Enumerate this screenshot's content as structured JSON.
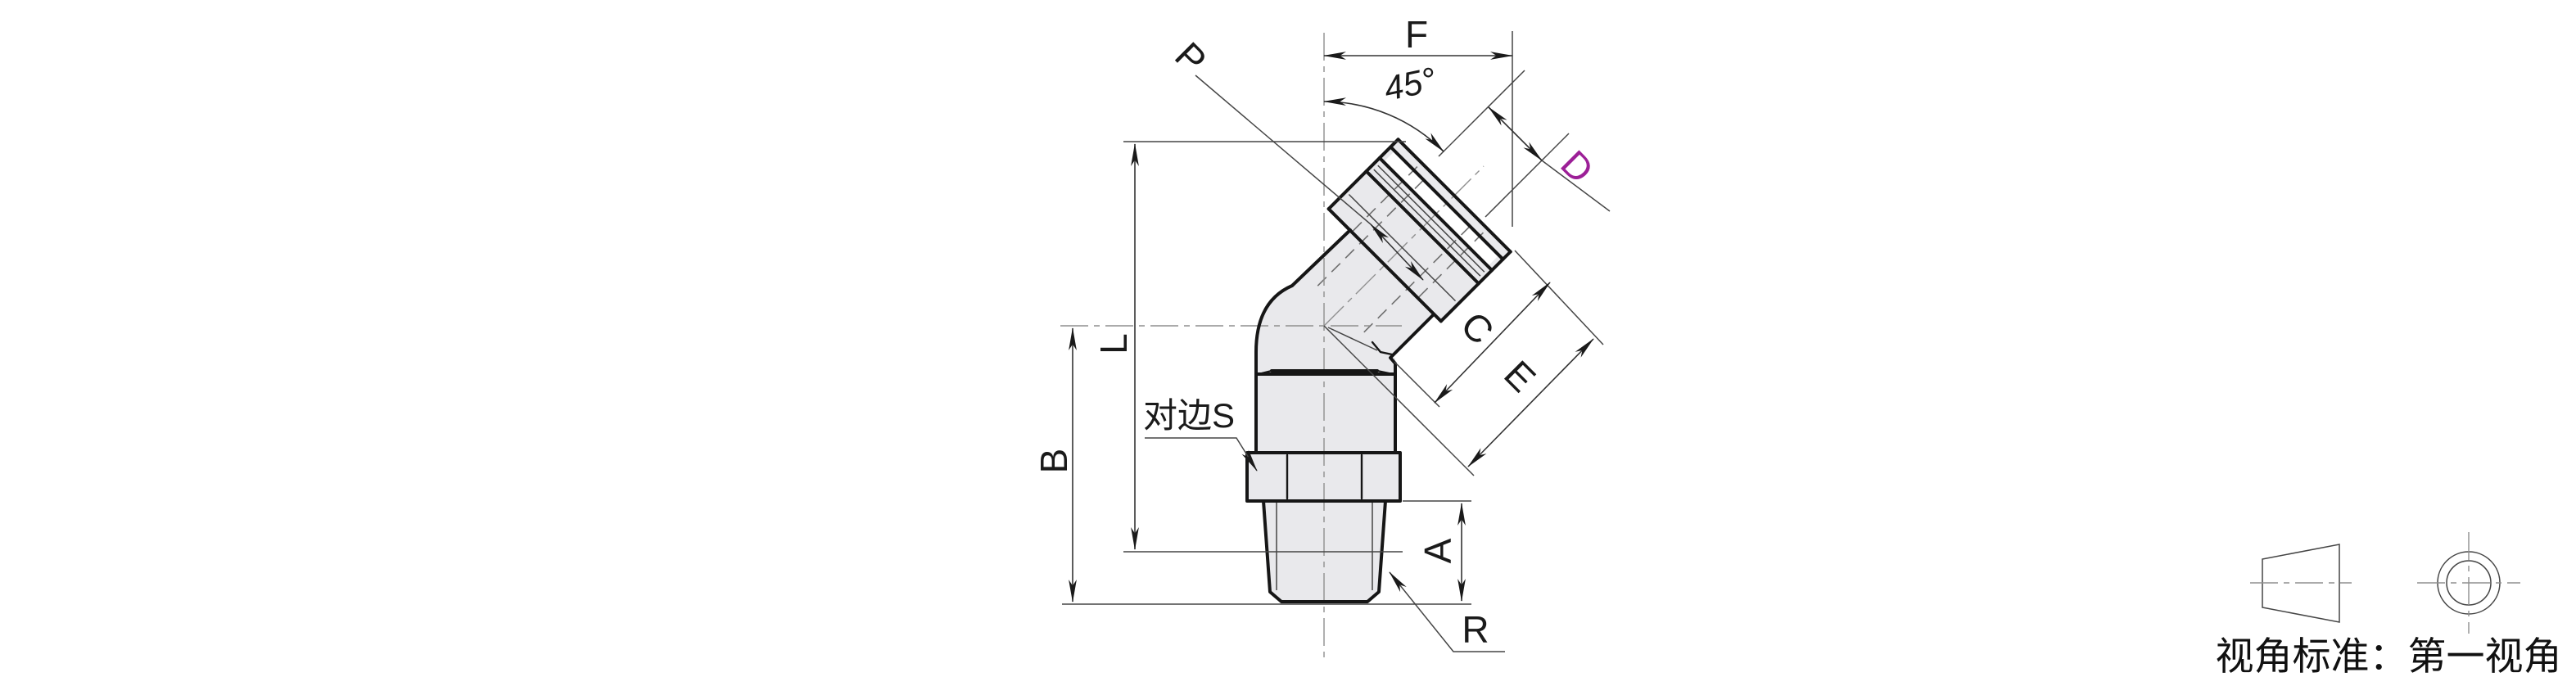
{
  "labels": {
    "f": "F",
    "angle": "45°",
    "p": "P",
    "d": "D",
    "c": "C",
    "e": "E",
    "l": "L",
    "b": "B",
    "a": "A",
    "r": "R",
    "across_flats": "对边S"
  },
  "projection": {
    "note": "视角标准：第一视角"
  },
  "colors": {
    "label_d_accent": "#9C1F97",
    "outline": "#161616",
    "body_fill": "#E9E9EC",
    "dimension_line": "#333333",
    "centerline": "#8F8F8F"
  }
}
